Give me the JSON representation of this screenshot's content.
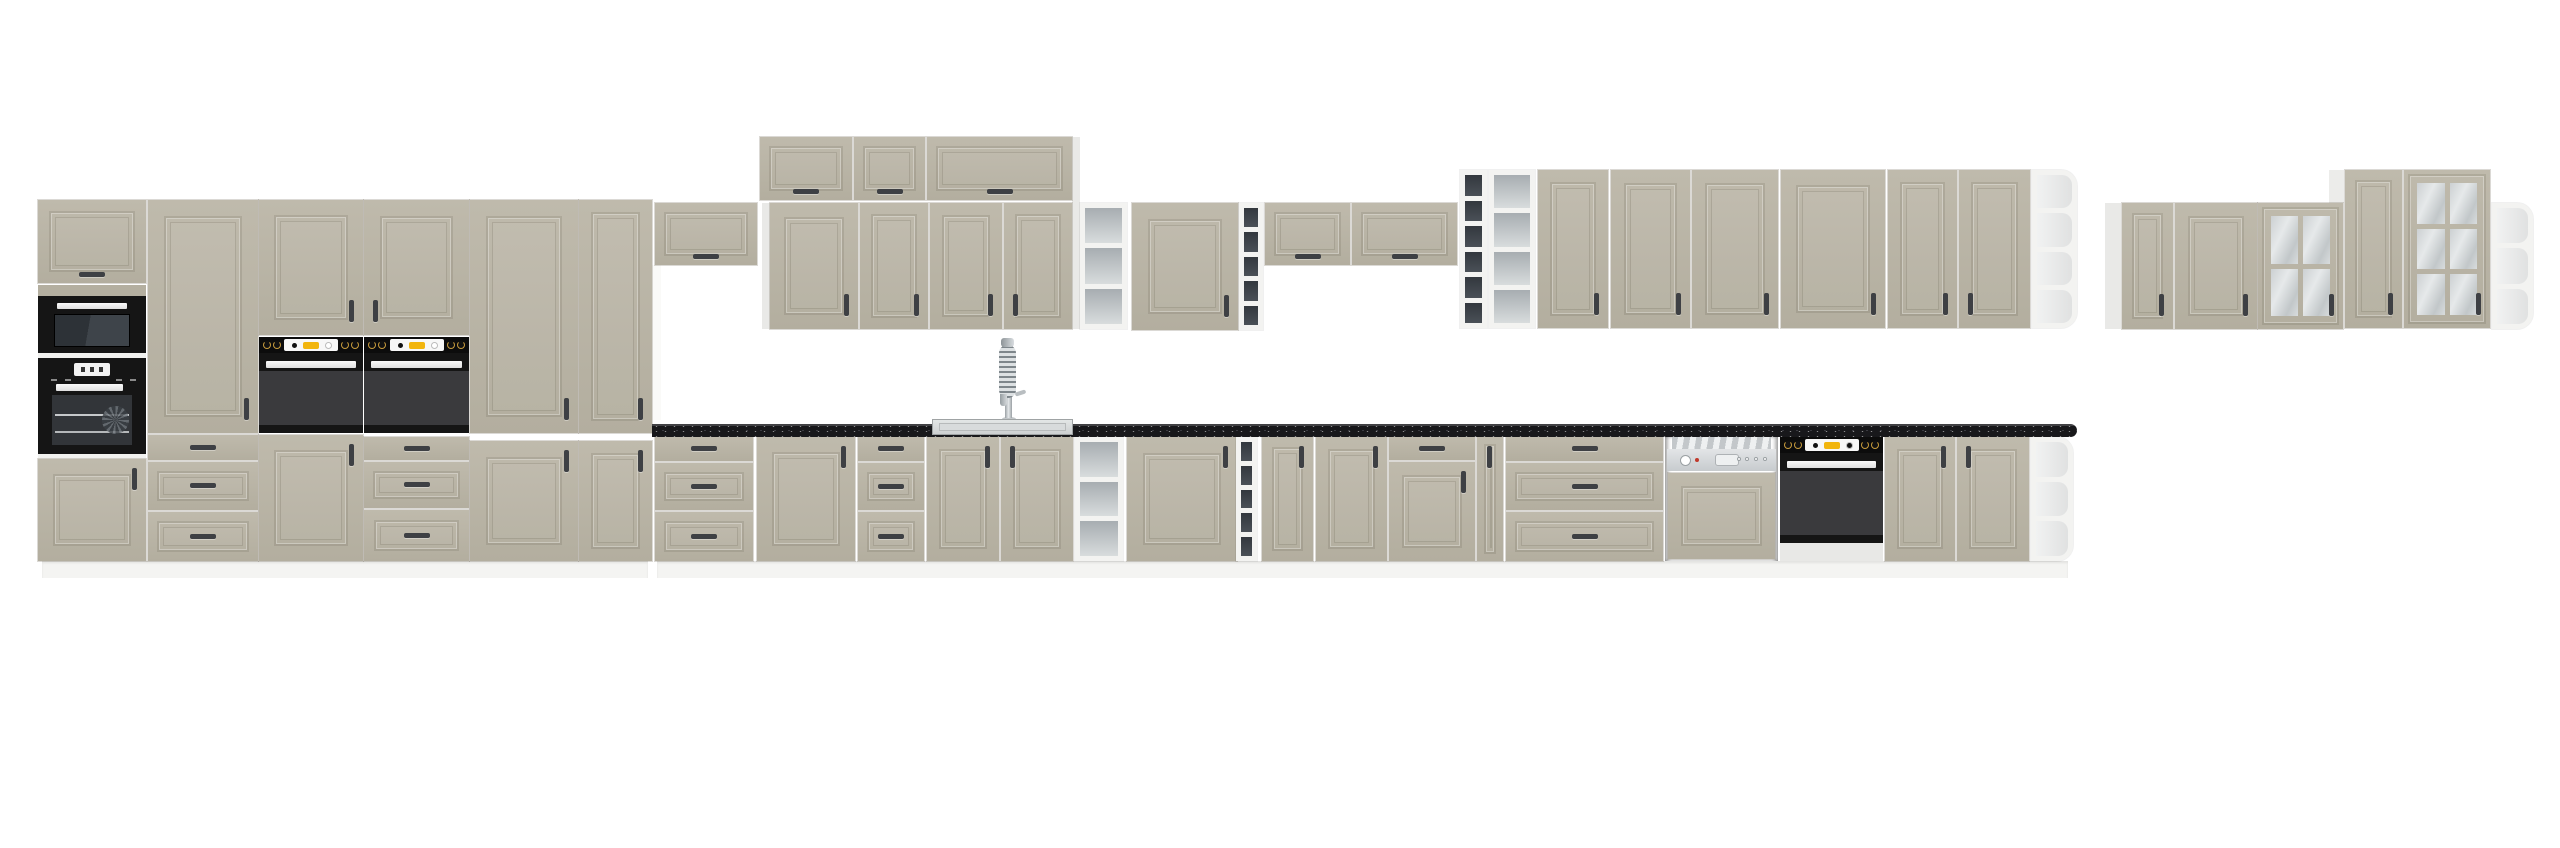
{
  "image": {
    "label": "kitchen-cabinet-set-product-render",
    "width": 2560,
    "height": 848,
    "background": "#ffffff"
  },
  "palette": {
    "front": "#b9b4a6",
    "front_light": "#c0bbad",
    "carcass": "#ebebe9",
    "plinth": "#f4f4f2",
    "counter_black": "#18181b",
    "appliance_black": "#151515",
    "oven_window": "#3a3a3d",
    "oven_accent_yellow": "#f2b50d",
    "knob_gold": "#c89b3c",
    "handle_dark": "#3e4044",
    "steel_light": "#d6d9db",
    "shelf_gray": "#aeb4b8",
    "wine_dark": "#3a3f46",
    "glass": "#ccd0d2"
  },
  "units": [
    {
      "name": "plinth-left-run",
      "kind": "plinth",
      "rect": [
        42,
        561,
        606,
        17
      ]
    },
    {
      "name": "plinth-base-run",
      "kind": "plinth",
      "rect": [
        657,
        561,
        1411,
        17
      ]
    },
    {
      "name": "side-panel-niche",
      "kind": "panel",
      "rect": [
        652,
        265,
        9,
        155
      ],
      "color": "#fafaf8"
    },
    {
      "name": "side-panel-wall-left",
      "kind": "panel",
      "rect": [
        762,
        203,
        8,
        126
      ],
      "color": "#e9e9e7"
    },
    {
      "name": "side-panel-stack-right",
      "kind": "panel",
      "rect": [
        1072,
        137,
        8,
        192
      ],
      "color": "#e9e9e7"
    },
    {
      "name": "side-panel-right-group",
      "kind": "panel",
      "rect": [
        2105,
        203,
        16,
        126
      ],
      "color": "#e9e9e7"
    },
    {
      "name": "side-panel-tall-glass-top",
      "kind": "panel",
      "rect": [
        2329,
        170,
        15,
        33
      ],
      "color": "#ececea"
    },
    {
      "name": "tall-a-flip-door",
      "kind": "flip",
      "rect": [
        38,
        200,
        108,
        83
      ],
      "h": "bc"
    },
    {
      "name": "tall-a-band",
      "kind": "panel",
      "rect": [
        38,
        285,
        108,
        11
      ],
      "color": "#b4afa0"
    },
    {
      "name": "tall-a-microwave",
      "kind": "microwave",
      "rect": [
        38,
        296,
        108,
        57
      ]
    },
    {
      "name": "tall-a-divider1",
      "kind": "panel",
      "rect": [
        38,
        353,
        108,
        5
      ],
      "color": "#f1f1ef"
    },
    {
      "name": "tall-a-oven-display",
      "kind": "oven-display",
      "rect": [
        38,
        358,
        108,
        96
      ]
    },
    {
      "name": "tall-a-divider2",
      "kind": "panel",
      "rect": [
        38,
        454,
        108,
        5
      ],
      "color": "#f1f1ef"
    },
    {
      "name": "tall-a-lower-door",
      "kind": "door",
      "rect": [
        38,
        459,
        108,
        102
      ],
      "h": "tr"
    },
    {
      "name": "tall-b-door",
      "kind": "door",
      "rect": [
        148,
        200,
        110,
        233
      ],
      "h": "br"
    },
    {
      "name": "tall-b-drawer1",
      "kind": "drawer",
      "rect": [
        148,
        435,
        110,
        25
      ],
      "framed": false
    },
    {
      "name": "tall-b-drawer2",
      "kind": "drawer",
      "rect": [
        148,
        462,
        110,
        48
      ],
      "framed": true
    },
    {
      "name": "tall-b-drawer3",
      "kind": "drawer",
      "rect": [
        148,
        512,
        110,
        49
      ],
      "framed": true
    },
    {
      "name": "tall-c-upper-door",
      "kind": "door",
      "rect": [
        259,
        200,
        104,
        135
      ],
      "h": "br"
    },
    {
      "name": "tall-c-oven",
      "kind": "oven-knobs",
      "rect": [
        259,
        337,
        104,
        96
      ]
    },
    {
      "name": "tall-c-lower-door",
      "kind": "door",
      "rect": [
        259,
        435,
        104,
        126
      ],
      "h": "tr"
    },
    {
      "name": "tall-d-upper-door",
      "kind": "door",
      "rect": [
        364,
        200,
        105,
        135
      ],
      "h": "bl"
    },
    {
      "name": "tall-d-oven",
      "kind": "oven-knobs",
      "rect": [
        364,
        337,
        105,
        96
      ]
    },
    {
      "name": "tall-d-drawer1",
      "kind": "drawer",
      "rect": [
        364,
        437,
        105,
        23
      ],
      "framed": false
    },
    {
      "name": "tall-d-drawer2",
      "kind": "drawer",
      "rect": [
        364,
        462,
        105,
        46
      ],
      "framed": true
    },
    {
      "name": "tall-d-drawer3",
      "kind": "drawer",
      "rect": [
        364,
        510,
        105,
        51
      ],
      "framed": true
    },
    {
      "name": "tall-e-door",
      "kind": "door",
      "rect": [
        470,
        200,
        108,
        233
      ],
      "h": "br"
    },
    {
      "name": "tall-e-lower-door",
      "kind": "door",
      "rect": [
        470,
        441,
        108,
        120
      ],
      "h": "tr"
    },
    {
      "name": "tall-f-door",
      "kind": "door",
      "rect": [
        579,
        200,
        73,
        233
      ],
      "h": "br"
    },
    {
      "name": "tall-f-lower-door",
      "kind": "door",
      "rect": [
        579,
        441,
        73,
        120
      ],
      "h": "tr"
    },
    {
      "name": "wall-bridge-cabinet-1",
      "kind": "flip",
      "rect": [
        655,
        203,
        102,
        62
      ],
      "h": "bc"
    },
    {
      "name": "wall-top-stack-1",
      "kind": "flip",
      "rect": [
        760,
        137,
        92,
        63
      ],
      "h": "bc"
    },
    {
      "name": "wall-top-stack-2",
      "kind": "flip",
      "rect": [
        854,
        137,
        71,
        63
      ],
      "h": "bc"
    },
    {
      "name": "wall-top-stack-3",
      "kind": "flip",
      "rect": [
        927,
        137,
        145,
        63
      ],
      "h": "bc"
    },
    {
      "name": "wall-door-1",
      "kind": "door",
      "rect": [
        770,
        203,
        88,
        126
      ],
      "h": "br"
    },
    {
      "name": "wall-door-2",
      "kind": "door",
      "rect": [
        860,
        203,
        68,
        126
      ],
      "h": "br"
    },
    {
      "name": "wall-door-3",
      "kind": "door",
      "rect": [
        930,
        203,
        72,
        126
      ],
      "h": "br"
    },
    {
      "name": "wall-door-4",
      "kind": "door",
      "rect": [
        1004,
        203,
        68,
        126
      ],
      "h": "bl"
    },
    {
      "name": "wall-open-shelf-1",
      "kind": "shelf",
      "rect": [
        1080,
        203,
        47,
        126
      ],
      "rows": 3,
      "tone": "gray"
    },
    {
      "name": "wall-door-5",
      "kind": "door",
      "rect": [
        1132,
        203,
        106,
        127
      ],
      "h": "br"
    },
    {
      "name": "wall-wine-shelf-1",
      "kind": "shelf",
      "rect": [
        1239,
        203,
        24,
        127
      ],
      "rows": 5,
      "tone": "dark"
    },
    {
      "name": "wall-bridge-cabinet-2",
      "kind": "flip",
      "rect": [
        1265,
        203,
        85,
        62
      ],
      "h": "bc"
    },
    {
      "name": "wall-bridge-cabinet-3",
      "kind": "flip",
      "rect": [
        1352,
        203,
        105,
        62
      ],
      "h": "bc"
    },
    {
      "name": "wall-wine-shelf-2",
      "kind": "shelf",
      "rect": [
        1460,
        170,
        27,
        158
      ],
      "rows": 6,
      "tone": "dark"
    },
    {
      "name": "wall-open-shelf-2",
      "kind": "shelf",
      "rect": [
        1489,
        170,
        46,
        158
      ],
      "rows": 4,
      "tone": "gray"
    },
    {
      "name": "wall-door-6",
      "kind": "door",
      "rect": [
        1538,
        170,
        70,
        158
      ],
      "h": "br"
    },
    {
      "name": "wall-door-7",
      "kind": "door",
      "rect": [
        1611,
        170,
        79,
        158
      ],
      "h": "br"
    },
    {
      "name": "wall-door-8",
      "kind": "door",
      "rect": [
        1692,
        170,
        86,
        158
      ],
      "h": "br"
    },
    {
      "name": "wall-door-9",
      "kind": "door",
      "rect": [
        1781,
        170,
        104,
        158
      ],
      "h": "br"
    },
    {
      "name": "wall-door-10",
      "kind": "door",
      "rect": [
        1888,
        170,
        69,
        158
      ],
      "h": "br"
    },
    {
      "name": "wall-door-11",
      "kind": "door",
      "rect": [
        1959,
        170,
        71,
        158
      ],
      "h": "bl"
    },
    {
      "name": "wall-end-shelf",
      "kind": "shelf",
      "rect": [
        2032,
        170,
        45,
        158
      ],
      "rows": 4,
      "tone": "end"
    },
    {
      "name": "right-wall-door-1",
      "kind": "door",
      "rect": [
        2122,
        203,
        51,
        126
      ],
      "h": "br"
    },
    {
      "name": "right-wall-door-2",
      "kind": "door",
      "rect": [
        2175,
        203,
        82,
        126
      ],
      "h": "br"
    },
    {
      "name": "right-glass-cabinet-1",
      "kind": "glass",
      "rect": [
        2258,
        203,
        85,
        126
      ],
      "grid": [
        2,
        2
      ],
      "h": "br"
    },
    {
      "name": "right-wall-tall-door",
      "kind": "door",
      "rect": [
        2345,
        170,
        57,
        158
      ],
      "h": "br"
    },
    {
      "name": "right-glass-cabinet-2",
      "kind": "glass",
      "rect": [
        2404,
        170,
        86,
        158
      ],
      "grid": [
        2,
        3
      ],
      "h": "br"
    },
    {
      "name": "right-end-shelf",
      "kind": "shelf",
      "rect": [
        2492,
        203,
        41,
        126
      ],
      "rows": 3,
      "tone": "end"
    },
    {
      "name": "base-drawers-1",
      "kind": "drawers3",
      "rect": [
        655,
        437,
        98,
        124
      ]
    },
    {
      "name": "base-door-1",
      "kind": "door",
      "rect": [
        757,
        437,
        98,
        124
      ],
      "h": "tr"
    },
    {
      "name": "base-drawers-2",
      "kind": "drawers3",
      "rect": [
        858,
        437,
        66,
        124
      ]
    },
    {
      "name": "sink-base-door-left",
      "kind": "door",
      "rect": [
        927,
        437,
        72,
        124
      ],
      "h": "tr"
    },
    {
      "name": "sink-base-door-right",
      "kind": "door",
      "rect": [
        1001,
        437,
        72,
        124
      ],
      "h": "tl"
    },
    {
      "name": "base-open-shelf-1",
      "kind": "shelf",
      "rect": [
        1075,
        437,
        48,
        124
      ],
      "rows": 3,
      "tone": "gray"
    },
    {
      "name": "base-door-2",
      "kind": "door",
      "rect": [
        1127,
        437,
        110,
        124
      ],
      "h": "tr"
    },
    {
      "name": "base-wine-shelf",
      "kind": "shelf",
      "rect": [
        1236,
        437,
        21,
        124
      ],
      "rows": 5,
      "tone": "dark"
    },
    {
      "name": "base-door-3",
      "kind": "door",
      "rect": [
        1262,
        437,
        51,
        124
      ],
      "h": "tr"
    },
    {
      "name": "base-door-4",
      "kind": "door",
      "rect": [
        1316,
        437,
        71,
        124
      ],
      "h": "tr"
    },
    {
      "name": "base-drawer-over-door-drawer",
      "kind": "drawer",
      "rect": [
        1389,
        437,
        86,
        23
      ],
      "framed": false
    },
    {
      "name": "base-drawer-over-door-door",
      "kind": "door",
      "rect": [
        1389,
        462,
        86,
        99
      ],
      "h": "tr"
    },
    {
      "name": "base-narrow-door",
      "kind": "door",
      "rect": [
        1477,
        437,
        26,
        124
      ],
      "h": "tc"
    },
    {
      "name": "base-drawers-3",
      "kind": "drawers3",
      "rect": [
        1506,
        437,
        157,
        124
      ]
    },
    {
      "name": "dishwasher",
      "kind": "dishwasher",
      "rect": [
        1665,
        437,
        113,
        124
      ]
    },
    {
      "name": "under-counter-oven",
      "kind": "oven-under",
      "rect": [
        1780,
        437,
        103,
        124
      ]
    },
    {
      "name": "base-door-5",
      "kind": "door",
      "rect": [
        1885,
        437,
        70,
        124
      ],
      "h": "tr"
    },
    {
      "name": "base-door-6",
      "kind": "door",
      "rect": [
        1957,
        437,
        72,
        124
      ],
      "h": "tl"
    },
    {
      "name": "base-end-shelf",
      "kind": "shelf",
      "rect": [
        2031,
        437,
        42,
        124
      ],
      "rows": 3,
      "tone": "end"
    },
    {
      "name": "faucet",
      "kind": "faucet",
      "rect": [
        996,
        338,
        30,
        84
      ]
    },
    {
      "name": "countertop",
      "kind": "counter",
      "rect": [
        652,
        424,
        1425,
        13
      ]
    },
    {
      "name": "sink",
      "kind": "sink",
      "rect": [
        932,
        419,
        141,
        16
      ]
    }
  ]
}
